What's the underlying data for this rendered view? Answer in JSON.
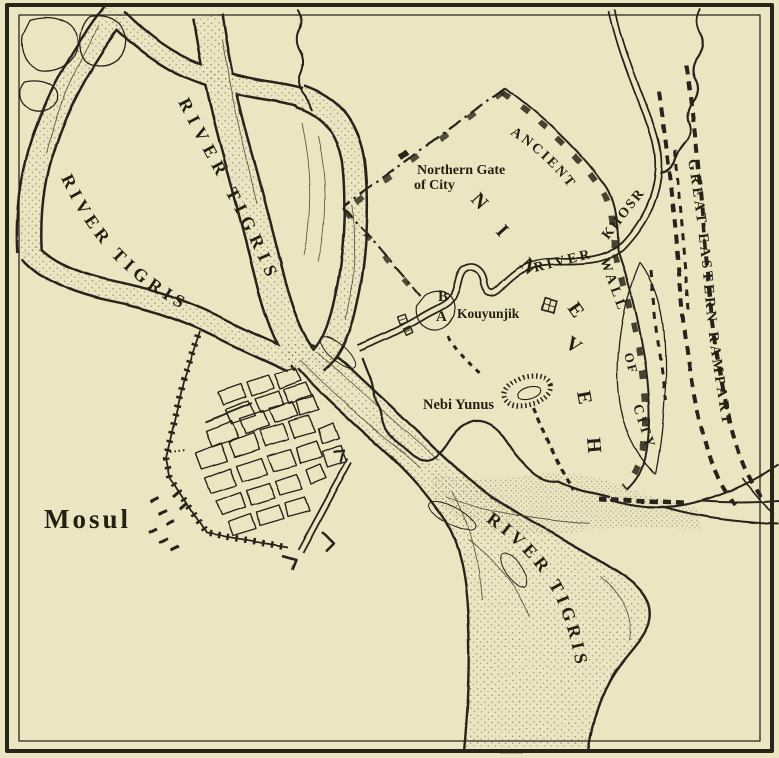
{
  "colors": {
    "background": "#ece5c1",
    "ink": "#29241a",
    "text": "#241f12"
  },
  "labels": {
    "river_tigris_west": "RIVER TIGRIS",
    "river_tigris_middle": "RIVER TIGRIS",
    "river_tigris_lower": "RIVER TIGRIS",
    "river_word": "RIVER",
    "khosr": "KHOSR",
    "ancient": "ANCIENT",
    "wall": "WALL",
    "of": "OF",
    "city": "CITY",
    "great_eastern_rampart": "GREAT EASTERN RAMPART",
    "nineveh_letters": [
      "N",
      "I",
      "N",
      "E",
      "V",
      "E",
      "H"
    ],
    "northern_gate_line1": "Northern Gate",
    "northern_gate_line2": "of City",
    "kouyunjik": "Kouyunjik",
    "nebi_yunus": "Nebi Yunus",
    "mosul": "Mosul",
    "mound_b": "B",
    "mound_a": "A"
  }
}
